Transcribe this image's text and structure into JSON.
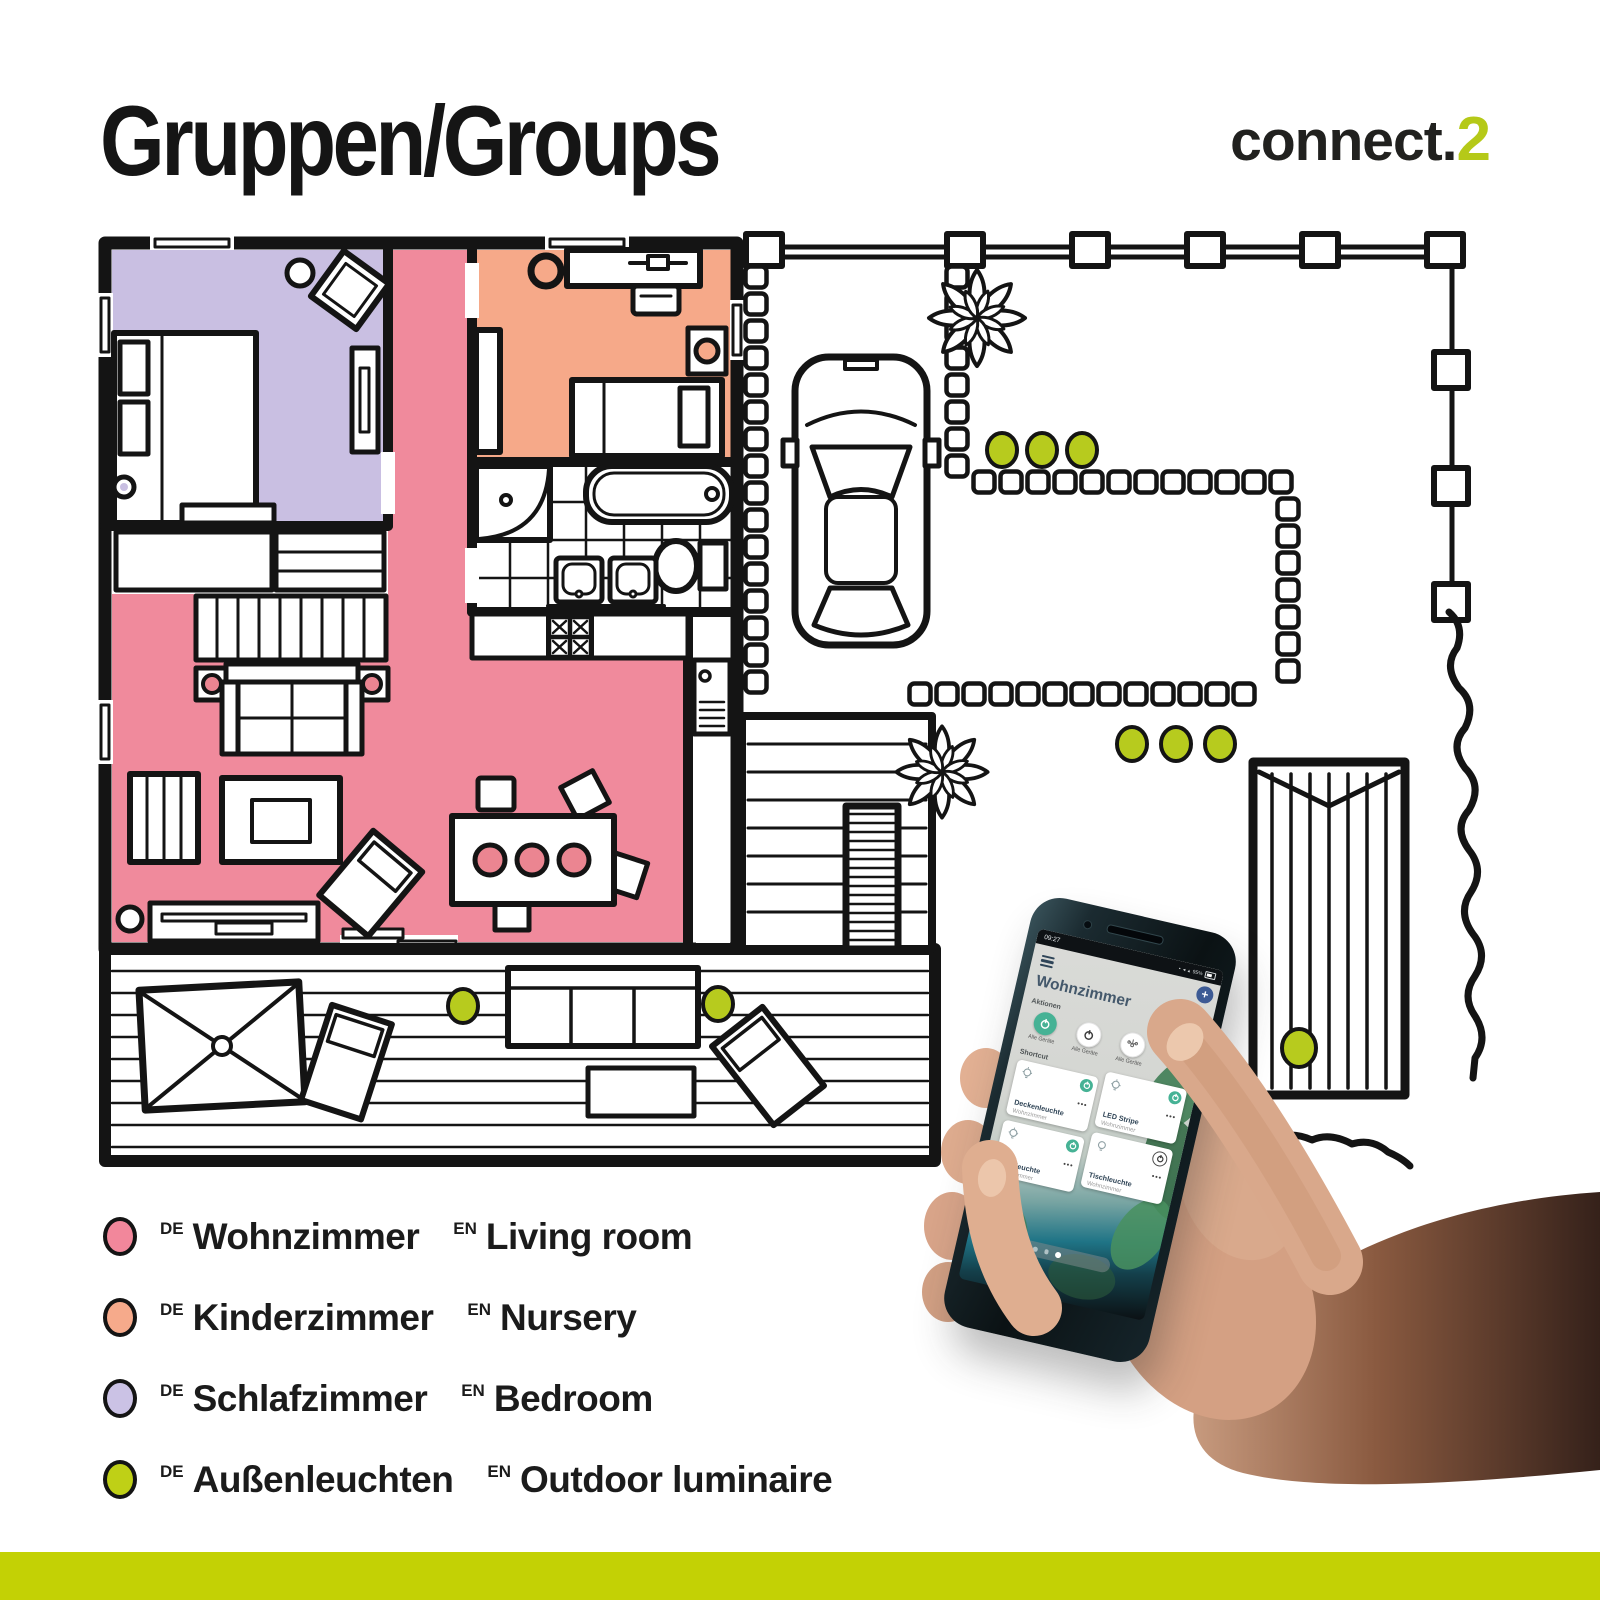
{
  "header": {
    "title": "Gruppen/Groups",
    "logo_prefix": "connect.",
    "logo_suffix": "2",
    "logo_suffix_color": "#b5c918"
  },
  "legend": {
    "items": [
      {
        "de_tag": "DE",
        "de": "Wohnzimmer",
        "en_tag": "EN",
        "en": "Living room",
        "color": "#f2879b"
      },
      {
        "de_tag": "DE",
        "de": "Kinderzimmer",
        "en_tag": "EN",
        "en": "Nursery",
        "color": "#f6aa8b"
      },
      {
        "de_tag": "DE",
        "de": "Schlafzimmer",
        "en_tag": "EN",
        "en": "Bedroom",
        "color": "#cbc2e5"
      },
      {
        "de_tag": "DE",
        "de": "Außenleuchten",
        "en_tag": "EN",
        "en": "Outdoor luminaire",
        "color": "#bfd016"
      }
    ]
  },
  "floorplan": {
    "rooms": [
      {
        "name": "Wohnzimmer / Living room",
        "color": "#f08a9c"
      },
      {
        "name": "Kinderzimmer / Nursery",
        "color": "#f6a989"
      },
      {
        "name": "Schlafzimmer / Bedroom",
        "color": "#c9bfe2"
      }
    ],
    "outdoor_light_color": "#b7cb1e",
    "accent_dot_color": "#eb8591"
  },
  "phone": {
    "statusbar": {
      "time": "09:27",
      "battery": "95%"
    },
    "app": {
      "title": "Wohnzimmer",
      "more_icon": "•••",
      "actions_label": "Aktionen",
      "actions": [
        {
          "label": "Alle Geräte",
          "state": "on"
        },
        {
          "label": "Alle Geräte",
          "state": "off"
        },
        {
          "label": "Alle Geräte",
          "state": "off"
        }
      ],
      "shortcut_label": "Shortcut",
      "devices": [
        {
          "name": "Deckenleuchte",
          "room": "Wohnzimmer",
          "more": "•••",
          "on": true
        },
        {
          "name": "LED Stripe",
          "room": "Wohnzimmer",
          "more": "•••",
          "on": true
        },
        {
          "name": "Stehleuchte",
          "room": "Wohnzimmer",
          "more": "•••",
          "on": true
        },
        {
          "name": "Tischleuchte",
          "room": "Wohnzimmer",
          "more": "•••",
          "on": false
        }
      ],
      "nav_icons": [
        "home",
        "page-dot",
        "page-dot",
        "page-dot-active"
      ]
    }
  },
  "footer": {
    "bar_color": "#c3d105"
  }
}
